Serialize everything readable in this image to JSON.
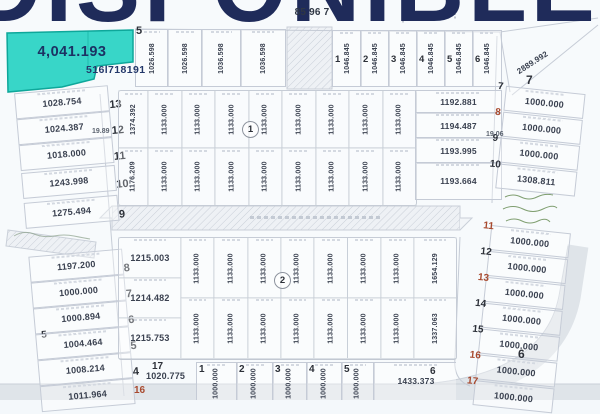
{
  "watermark": {
    "text": "DISPONIBLE",
    "color": "#1f2b5a"
  },
  "contact_number": "516l718191",
  "top_boundary_label": "85 96 7",
  "highlighted_lot": {
    "area": "4,041.193",
    "lot_number": "5",
    "fill": "#38d6c8"
  },
  "left_column": {
    "road_width_label": "19.89",
    "lots": [
      {
        "number": "13",
        "area": "1028.754"
      },
      {
        "number": "12",
        "area": "1024.387"
      },
      {
        "number": "11",
        "area": "1018.000"
      },
      {
        "number": "10",
        "area": "1243.998"
      },
      {
        "number": "9",
        "area": "1275.494"
      },
      {
        "number": "8",
        "area": "1197.200"
      },
      {
        "number": "7",
        "area": "1000.000"
      },
      {
        "number": "6",
        "area": "1000.894",
        "side_label": "5"
      },
      {
        "number": "5",
        "area": "1004.464"
      },
      {
        "number": "4",
        "area": "1008.214"
      },
      {
        "number": "",
        "area": "1011.964"
      }
    ]
  },
  "top_row": {
    "left_lots": [
      "1026.598",
      "1026.598",
      "1036.598",
      "1036.598"
    ],
    "right_lots": [
      {
        "number": "1",
        "area": "1046.845"
      },
      {
        "number": "2",
        "area": "1046.845"
      },
      {
        "number": "3",
        "area": "1046.845"
      },
      {
        "number": "4",
        "area": "1046.845"
      },
      {
        "number": "5",
        "area": "1046.845"
      },
      {
        "number": "6",
        "area": "1046.845"
      }
    ],
    "corner_lot": {
      "number": "7",
      "area": "2889.992"
    }
  },
  "block1": {
    "label": "1",
    "first_col": {
      "top": "1374.392",
      "bottom": "1176.209"
    },
    "grid_area": "1133.000",
    "east_lots": [
      "1192.881",
      "1194.487",
      "1193.995",
      "1193.664"
    ]
  },
  "block2": {
    "label": "2",
    "west_lots": [
      "1215.003",
      "1214.482",
      "1215.753"
    ],
    "grid_area": "1133.000",
    "last_col": {
      "top": "1654.129",
      "bottom": "1337.063"
    }
  },
  "bottom_row": {
    "west_number": "17",
    "west_area": "1020.775",
    "west_red_number": "16",
    "lots": [
      {
        "number": "1",
        "area": "1000.000"
      },
      {
        "number": "2",
        "area": "1000.000"
      },
      {
        "number": "3",
        "area": "1000.000"
      },
      {
        "number": "4",
        "area": "1000.000"
      },
      {
        "number": "5",
        "area": "1000.000"
      }
    ],
    "wide_lot": {
      "number": "6",
      "area": "1433.373"
    }
  },
  "right_column": {
    "road_width_label": "19.06",
    "block_label": "6",
    "lots": [
      {
        "number": "7",
        "area": "1000.000",
        "red": false
      },
      {
        "number": "8",
        "area": "1000.000",
        "red": true
      },
      {
        "number": "9",
        "area": "1000.000",
        "red": false
      },
      {
        "number": "10",
        "area": "1308.811",
        "red": false
      },
      {
        "number": "11",
        "area": "1000.000",
        "red": true
      },
      {
        "number": "12",
        "area": "1000.000",
        "red": false
      },
      {
        "number": "13",
        "area": "1000.000",
        "red": true
      },
      {
        "number": "14",
        "area": "1000.000",
        "red": false
      },
      {
        "number": "15",
        "area": "1000.000",
        "red": false
      },
      {
        "number": "16",
        "area": "1000.000",
        "red": true
      },
      {
        "number": "17",
        "area": "1000.000",
        "red": true
      }
    ]
  }
}
